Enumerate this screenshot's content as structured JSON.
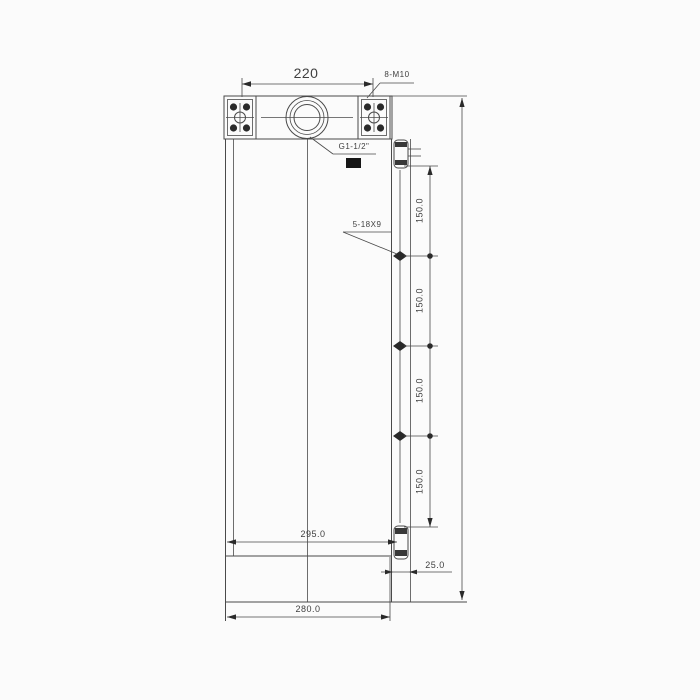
{
  "colors": {
    "background": "#fbfbfb",
    "line": "#4a4a4a",
    "text": "#3f3f3f",
    "fill": "#2a2a2a"
  },
  "drawing": {
    "dimensions": {
      "flange_spacing": "220",
      "flange_tapped_holes": "8-M10",
      "port_thread": "G1-1/2\"",
      "side_mounting_slots": "5-18X9",
      "slot_pitch": [
        "150.0",
        "150.0",
        "150.0",
        "150.0"
      ],
      "width_to_bracket": "295.0",
      "bracket_width": "25.0",
      "overall_width": "280.0"
    }
  }
}
